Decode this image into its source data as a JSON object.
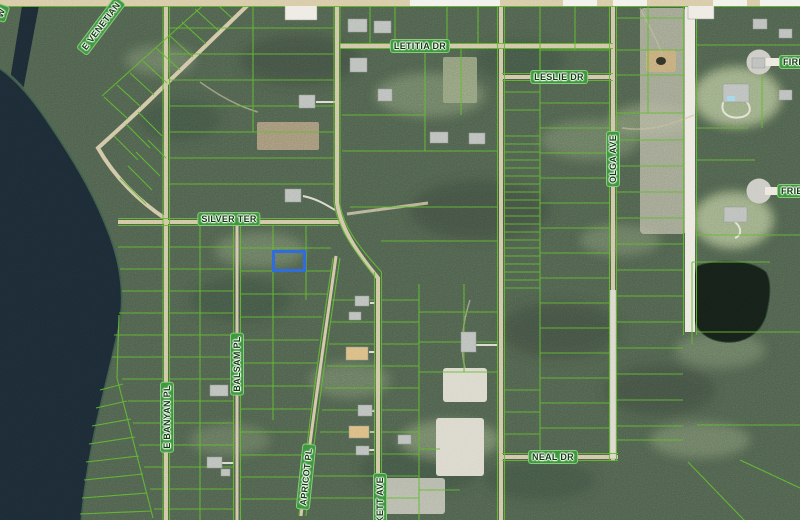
{
  "map": {
    "description": "Aerial parcel map with green lot boundaries and a blue selected parcel",
    "streets": {
      "w_partial": "W",
      "e_venetian": "E VENETIAN",
      "letitia_dr": "LETITIA DR",
      "leslie_dr": "LESLIE DR",
      "fire_partial": "FIRE",
      "frie_partial": "FRIE",
      "olga_ave": "OLGA AVE",
      "silver_ter": "SILVER TER",
      "balsam_pl": "BALSAM PL",
      "e_banyan_pl": "E BANYAN PL",
      "apricot_pl": "APRICOT PL",
      "kett_ave_partial": "KETT AVE",
      "neal_dr": "NEAL DR"
    },
    "colors": {
      "parcel_line": "#5cb42e",
      "label_bg": "#3f9a3f",
      "label_text": "#123c10",
      "highlight": "#2e6ce0",
      "road": "#cfc4a2",
      "sand_road": "#eae7dd",
      "water": "#1b2933"
    },
    "highlight_parcel": {
      "x": 272,
      "y": 250,
      "w": 34,
      "h": 22
    }
  }
}
